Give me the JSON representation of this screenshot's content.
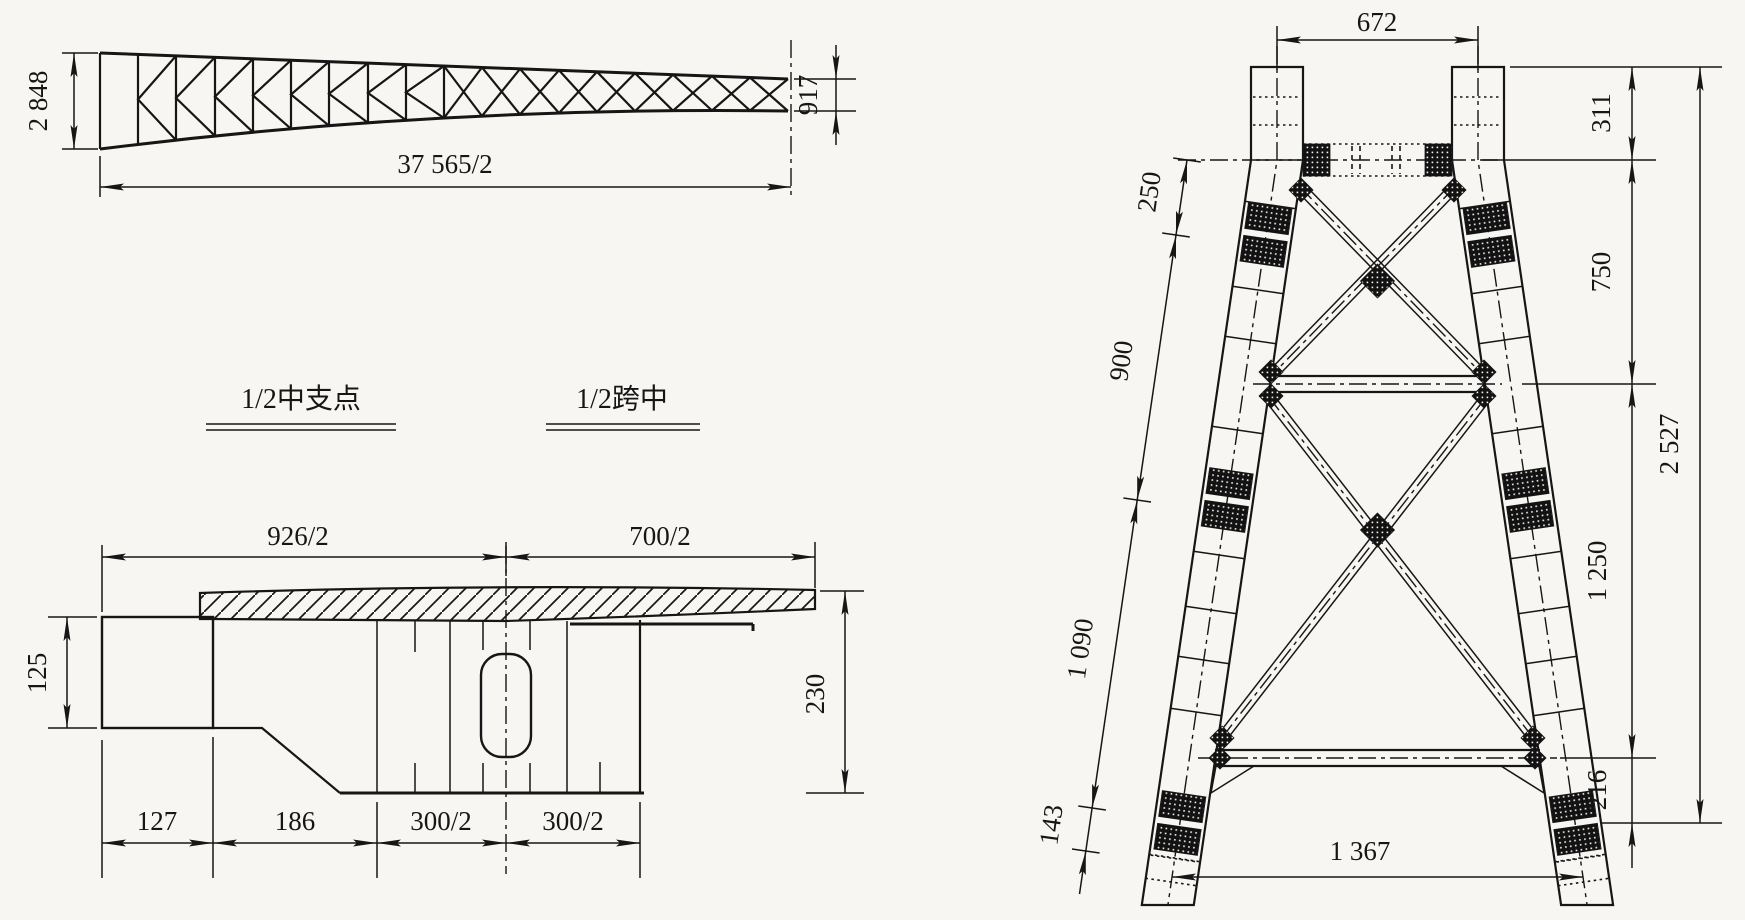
{
  "background": "#f7f6f2",
  "ink": "#161616",
  "truss_elevation": {
    "depth_left": "2 848",
    "half_span": "37 565/2",
    "depth_right": "917"
  },
  "cross_section": {
    "left_title": "1/2中支点",
    "right_title": "1/2跨中",
    "top_width_left": "926/2",
    "top_width_right": "700/2",
    "anchor_box_height": "125",
    "web_height_right": "230",
    "bottom_widths": [
      "127",
      "186",
      "300/2",
      "300/2"
    ]
  },
  "tower_elevation": {
    "top_width": "672",
    "right_dims": [
      "311",
      "750",
      "1 250",
      "216"
    ],
    "total_height": "2 527",
    "left_dims": [
      "250",
      "900",
      "1 090",
      "143"
    ],
    "base_width": "1 367"
  }
}
